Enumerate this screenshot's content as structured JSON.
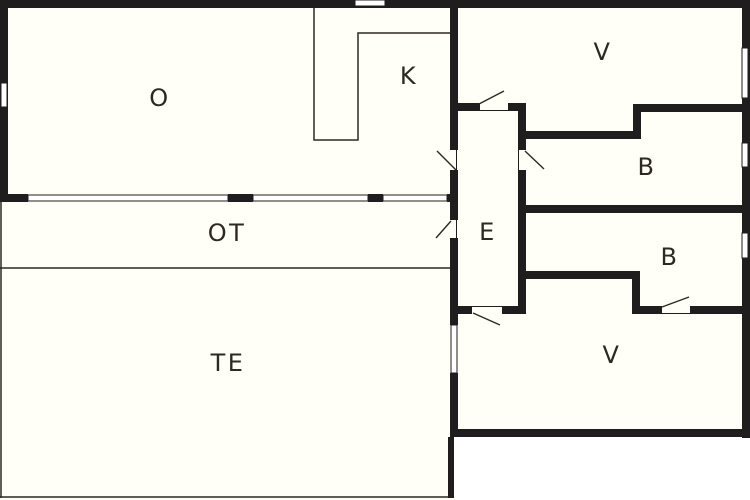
{
  "plan": {
    "type": "floor-plan",
    "canvas": {
      "width": 750,
      "height": 500
    },
    "colors": {
      "wall": "#1f1d1d",
      "interior": "#fffef7",
      "exterior": "#ffffff",
      "label": "#2b2922",
      "thin_line": "#2b2922",
      "window_fill": "#ffffff"
    },
    "rooms": [
      {
        "id": "o",
        "label": "O",
        "cx": 160,
        "cy": 98
      },
      {
        "id": "k",
        "label": "K",
        "cx": 409,
        "cy": 76
      },
      {
        "id": "v-top",
        "label": "V",
        "cx": 603,
        "cy": 52
      },
      {
        "id": "b-upper",
        "label": "B",
        "cx": 647,
        "cy": 167
      },
      {
        "id": "b-lower",
        "label": "B",
        "cx": 670,
        "cy": 257
      },
      {
        "id": "v-bottom",
        "label": "V",
        "cx": 612,
        "cy": 355
      },
      {
        "id": "e",
        "label": "E",
        "cx": 488,
        "cy": 232
      },
      {
        "id": "ot",
        "label": "OT",
        "cx": 227,
        "cy": 233
      },
      {
        "id": "te",
        "label": "TE",
        "cx": 228,
        "cy": 363
      }
    ],
    "label_font_size": 24,
    "label_letter_spacing": 2.5,
    "walls": [
      [
        0,
        0,
        750,
        8
      ],
      [
        0,
        8,
        8,
        194
      ],
      [
        8,
        194,
        20,
        8
      ],
      [
        228,
        194,
        25,
        8
      ],
      [
        368,
        194,
        15,
        8
      ],
      [
        447,
        194,
        11,
        8
      ],
      [
        450,
        8,
        8,
        142
      ],
      [
        450,
        170,
        8,
        50
      ],
      [
        450,
        238,
        8,
        87
      ],
      [
        450,
        373,
        8,
        64
      ],
      [
        448,
        437,
        6,
        61
      ],
      [
        742,
        0,
        8,
        438
      ],
      [
        450,
        429,
        300,
        8
      ],
      [
        458,
        103,
        22,
        8
      ],
      [
        508,
        103,
        18,
        8
      ],
      [
        518,
        103,
        8,
        47
      ],
      [
        518,
        170,
        8,
        144
      ],
      [
        641,
        104,
        109,
        8
      ],
      [
        633,
        104,
        8,
        35
      ],
      [
        526,
        131,
        107,
        8
      ],
      [
        518,
        205,
        232,
        8
      ],
      [
        518,
        271,
        114,
        8
      ],
      [
        632,
        271,
        8,
        43
      ],
      [
        640,
        306,
        22,
        8
      ],
      [
        690,
        306,
        60,
        8
      ],
      [
        450,
        306,
        22,
        8
      ],
      [
        502,
        306,
        24,
        8
      ]
    ],
    "windows": [
      {
        "x": 1,
        "y": 83,
        "w": 6,
        "h": 24
      },
      {
        "x": 355,
        "y": 0,
        "w": 30,
        "h": 6
      },
      {
        "x": 28,
        "y": 195,
        "w": 200,
        "h": 6
      },
      {
        "x": 253,
        "y": 195,
        "w": 115,
        "h": 6
      },
      {
        "x": 383,
        "y": 195,
        "w": 64,
        "h": 6
      },
      {
        "x": 742,
        "y": 48,
        "w": 6,
        "h": 50
      },
      {
        "x": 742,
        "y": 143,
        "w": 6,
        "h": 24
      },
      {
        "x": 742,
        "y": 233,
        "w": 6,
        "h": 25
      },
      {
        "x": 451,
        "y": 325,
        "w": 6,
        "h": 48
      }
    ],
    "door_swings": [
      [
        456,
        170,
        437,
        151
      ],
      [
        451,
        221,
        436,
        238
      ],
      [
        479,
        104,
        504,
        91
      ],
      [
        525,
        151,
        544,
        169
      ],
      [
        473,
        313,
        500,
        325
      ],
      [
        662,
        307,
        689,
        297
      ]
    ],
    "door_edges": [
      [
        456,
        150,
        1,
        20
      ],
      [
        456,
        220,
        1,
        18
      ],
      [
        480,
        110,
        28,
        1
      ],
      [
        518,
        150,
        1,
        20
      ],
      [
        472,
        306,
        30,
        1
      ],
      [
        662,
        313,
        28,
        1
      ]
    ],
    "thin_polylines": [
      [
        [
          314,
          8
        ],
        [
          314,
          140
        ],
        [
          358,
          140
        ],
        [
          358,
          33
        ],
        [
          452,
          33
        ]
      ],
      [
        [
          0,
          268
        ],
        [
          450,
          268
        ]
      ],
      [
        [
          1,
          202
        ],
        [
          1,
          498
        ]
      ],
      [
        [
          0,
          497
        ],
        [
          452,
          497
        ]
      ]
    ],
    "exterior_rects": [
      [
        454,
        437,
        296,
        63
      ]
    ]
  }
}
